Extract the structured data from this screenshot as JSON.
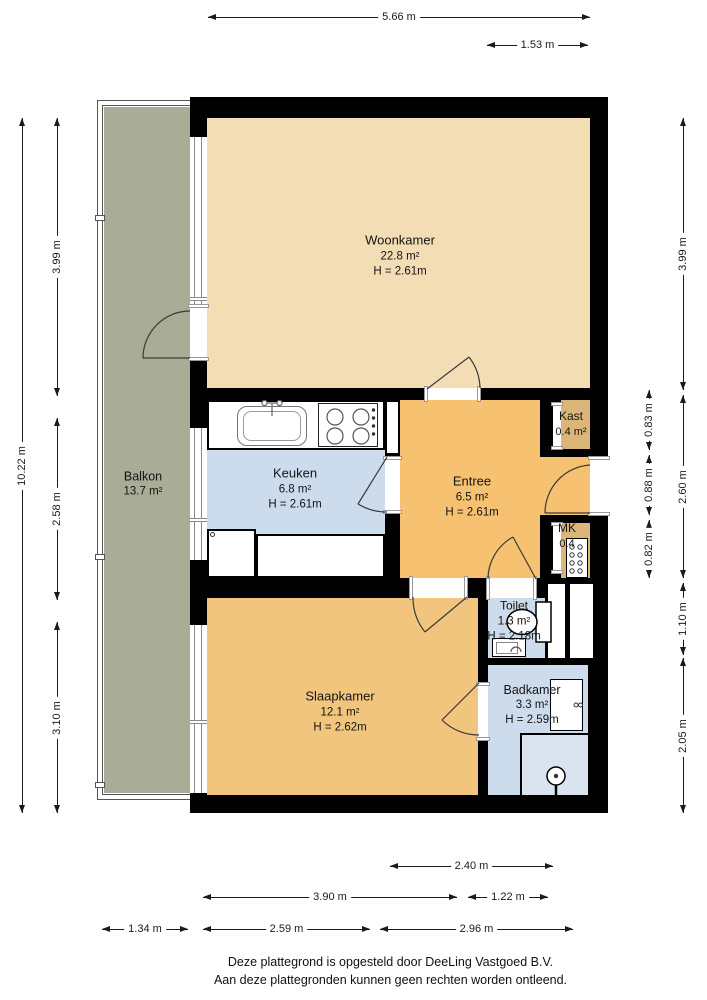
{
  "floorplan": {
    "rooms": {
      "woonkamer": {
        "name": "Woonkamer",
        "area": "22.8 m²",
        "height": "H = 2.61m"
      },
      "keuken": {
        "name": "Keuken",
        "area": "6.8 m²",
        "height": "H = 2.61m"
      },
      "entree": {
        "name": "Entree",
        "area": "6.5 m²",
        "height": "H = 2.61m"
      },
      "kast": {
        "name": "Kast",
        "area": "0.4 m²"
      },
      "mk": {
        "name": "MK",
        "area": "0.4"
      },
      "toilet": {
        "name": "Toilet",
        "area": "1.3 m²",
        "height": "H = 2.18m"
      },
      "slaapkamer": {
        "name": "Slaapkamer",
        "area": "12.1 m²",
        "height": "H = 2.62m"
      },
      "badkamer": {
        "name": "Badkamer",
        "area": "3.3 m²",
        "height": "H = 2.59m"
      },
      "balkon": {
        "name": "Balkon",
        "area": "13.7 m²"
      }
    },
    "dimensions": {
      "top": [
        "5.66 m",
        "1.53 m"
      ],
      "left": [
        "10.22 m",
        "3.99 m",
        "2.58 m",
        "3.10 m"
      ],
      "right": [
        "0.83 m",
        "0.88 m",
        "0.82 m",
        "3.99 m",
        "2.60 m",
        "1.10 m",
        "2.05 m"
      ],
      "bottom": [
        "2.40 m",
        "3.90 m",
        "1.22 m",
        "1.34 m",
        "2.59 m",
        "2.96 m"
      ]
    },
    "colors": {
      "wall": "#000000",
      "woonkamer": "#f2ddb4",
      "entree": "#f6c171",
      "slaapkamer": "#f2c57e",
      "blauw": "#cddcec",
      "bruin": "#dcb678",
      "douche": "#d9e4f0",
      "balkon": "#a9ac96"
    },
    "footer": {
      "line1": "Deze plattegrond is opgesteld door DeeLing Vastgoed B.V.",
      "line2": "Aan deze plattegronden kunnen geen rechten worden ontleend."
    }
  }
}
